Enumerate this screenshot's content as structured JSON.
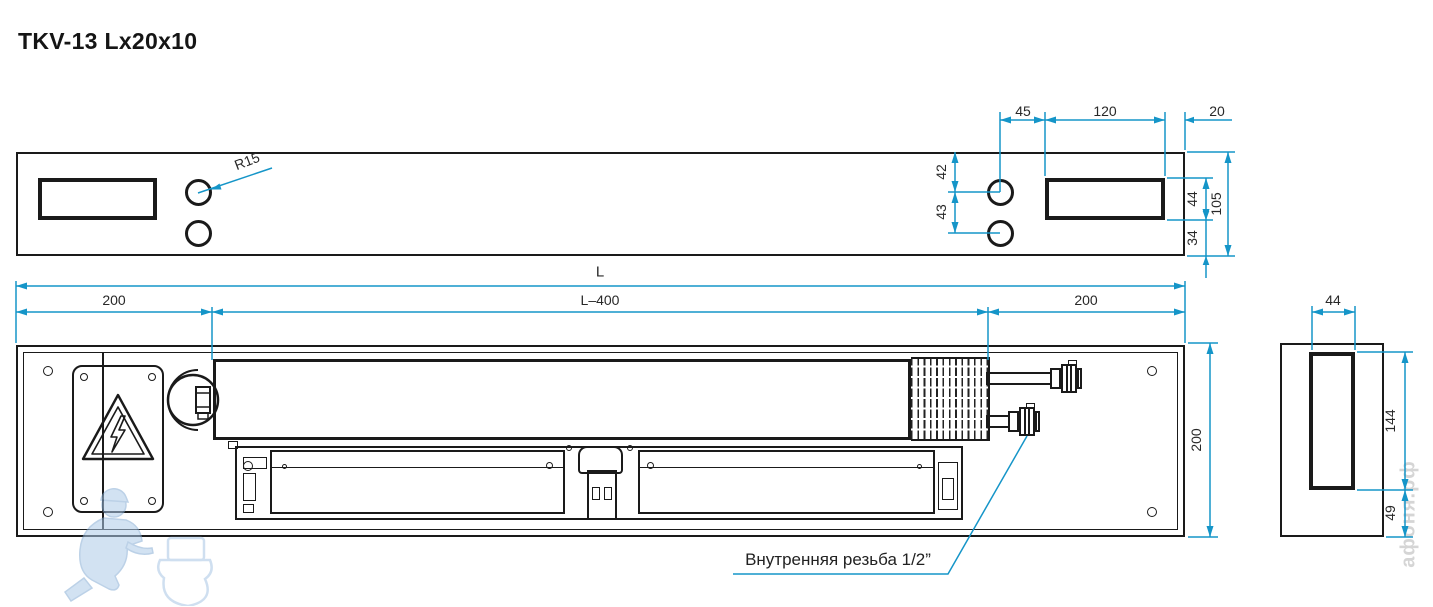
{
  "title": "TKV-13 Lx20x10",
  "colors": {
    "dimension": "#1595c8",
    "line": "#1a1a1a"
  },
  "elevation_dims": {
    "r15": "R15",
    "w45": "45",
    "w120": "120",
    "w20": "20",
    "h42": "42",
    "h43": "43",
    "h44": "44",
    "h105": "105",
    "h34": "34"
  },
  "plan_dims": {
    "length": "L",
    "inner": "L–400",
    "left": "200",
    "right": "200",
    "depth": "200"
  },
  "side_dims": {
    "w44": "44",
    "h144": "144",
    "h49": "49"
  },
  "note": {
    "thread": "Внутренняя резьба 1/2”"
  },
  "watermark": {
    "site": "афоня.рф"
  }
}
